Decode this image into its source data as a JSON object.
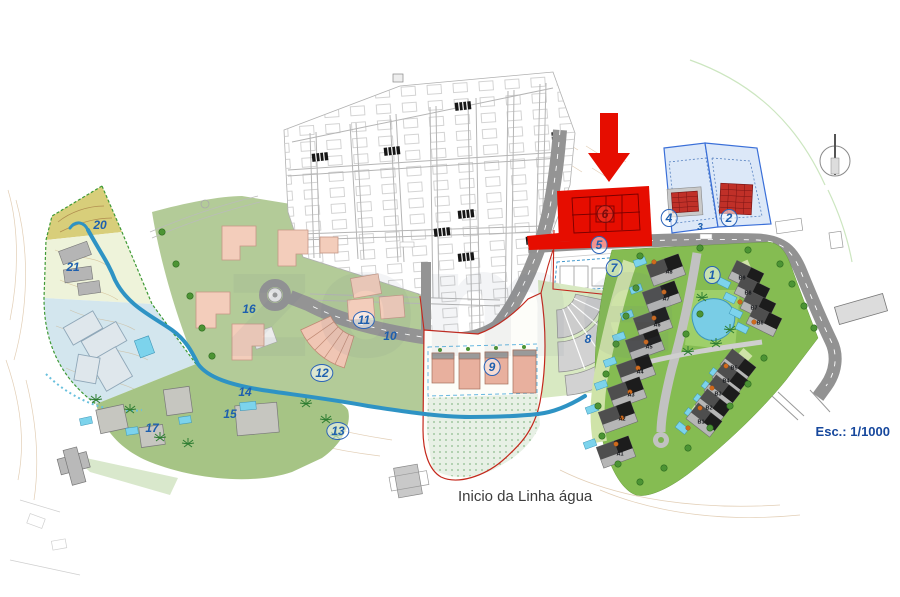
{
  "plan": {
    "scale_label": "Esc.: 1/1000",
    "water_annotation": "Inicio da Linha água",
    "watermark": "zome",
    "highlight_color": "#e60d00",
    "label_color": "#1d5fae",
    "highlighted_lot": "6",
    "lot_labels": [
      {
        "id": "1",
        "text": "1",
        "x": 712,
        "y": 275,
        "circled": true
      },
      {
        "id": "2",
        "text": "2",
        "x": 729,
        "y": 218,
        "circled": true
      },
      {
        "id": "3",
        "text": "3",
        "x": 700,
        "y": 228,
        "circled": false
      },
      {
        "id": "4",
        "text": "4",
        "x": 669,
        "y": 218,
        "circled": true
      },
      {
        "id": "5",
        "text": "5",
        "x": 599,
        "y": 245,
        "circled": true
      },
      {
        "id": "6",
        "text": "6",
        "x": 605,
        "y": 214,
        "circled": true
      },
      {
        "id": "7",
        "text": "7",
        "x": 614,
        "y": 268,
        "circled": true
      },
      {
        "id": "8",
        "text": "8",
        "x": 588,
        "y": 339,
        "circled": false
      },
      {
        "id": "9",
        "text": "9",
        "x": 492,
        "y": 367,
        "circled": true
      },
      {
        "id": "10",
        "text": "10",
        "x": 390,
        "y": 336,
        "circled": false
      },
      {
        "id": "11",
        "text": "11",
        "x": 364,
        "y": 320,
        "circled": true
      },
      {
        "id": "12",
        "text": "12",
        "x": 322,
        "y": 373,
        "circled": true
      },
      {
        "id": "13",
        "text": "13",
        "x": 338,
        "y": 431,
        "circled": true
      },
      {
        "id": "14",
        "text": "14",
        "x": 245,
        "y": 392,
        "circled": false
      },
      {
        "id": "15",
        "text": "15",
        "x": 230,
        "y": 414,
        "circled": false
      },
      {
        "id": "16",
        "text": "16",
        "x": 249,
        "y": 309,
        "circled": false
      },
      {
        "id": "17",
        "text": "17",
        "x": 152,
        "y": 428,
        "circled": false
      },
      {
        "id": "20",
        "text": "20",
        "x": 100,
        "y": 225,
        "circled": false
      },
      {
        "id": "21",
        "text": "21",
        "x": 73,
        "y": 267,
        "circled": false
      }
    ],
    "unit_labels": [
      {
        "id": "A8",
        "text": "A8",
        "x": 669,
        "y": 273
      },
      {
        "id": "A7",
        "text": "A7",
        "x": 666,
        "y": 300
      },
      {
        "id": "A6",
        "text": "A6",
        "x": 657,
        "y": 326
      },
      {
        "id": "A5",
        "text": "A5",
        "x": 649,
        "y": 348
      },
      {
        "id": "A4",
        "text": "A4",
        "x": 640,
        "y": 373
      },
      {
        "id": "A3",
        "text": "A3",
        "x": 631,
        "y": 396
      },
      {
        "id": "A2",
        "text": "A2",
        "x": 622,
        "y": 420
      },
      {
        "id": "A1",
        "text": "A1",
        "x": 620,
        "y": 455
      },
      {
        "id": "B9",
        "text": "B9",
        "x": 742,
        "y": 279
      },
      {
        "id": "B8",
        "text": "B8",
        "x": 748,
        "y": 294
      },
      {
        "id": "B7",
        "text": "B7",
        "x": 754,
        "y": 309
      },
      {
        "id": "B6",
        "text": "B6",
        "x": 760,
        "y": 324
      },
      {
        "id": "B5",
        "text": "B5",
        "x": 734,
        "y": 369
      },
      {
        "id": "B4",
        "text": "B4",
        "x": 726,
        "y": 382
      },
      {
        "id": "B3",
        "text": "B3",
        "x": 718,
        "y": 395
      },
      {
        "id": "B2",
        "text": "B2",
        "x": 709,
        "y": 409
      },
      {
        "id": "B1",
        "text": "B1",
        "x": 701,
        "y": 423
      }
    ]
  }
}
